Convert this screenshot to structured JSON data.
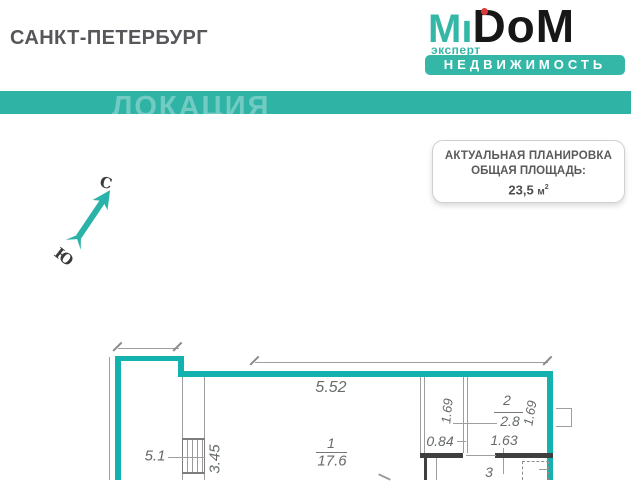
{
  "colors": {
    "brand_teal": "#35b7a8",
    "ribbon_teal": "#2fb3a5",
    "wall_teal": "#14b2ae",
    "logo_dot_red": "#d93a35",
    "logo_black": "#171717"
  },
  "header": {
    "city": "САНКТ-ПЕТЕРБУРГ"
  },
  "logo": {
    "m": "M",
    "i_stem": "ı",
    "rest": "DoM",
    "tagline": "эксперт",
    "banner": "НЕДВИЖИМОСТЬ"
  },
  "ribbon": {
    "watermark": "ЛОКАЦИЯ"
  },
  "badge": {
    "title": "АКТУАЛЬНАЯ ПЛАНИРОВКА",
    "subtitle": "ОБЩАЯ ПЛОЩАДЬ:",
    "value": "23,5",
    "unit": "м",
    "unit_sup": "2"
  },
  "compass": {
    "north": "С",
    "south": "Ю"
  },
  "plan": {
    "dim_top_width": "5.52",
    "dim_left_width": "5.1",
    "dim_wall_depth": "3.45",
    "dim_h_left": "1.69",
    "dim_h_right": "1.69",
    "dim_084": "0.84",
    "dim_163": "1.63",
    "room1": {
      "num": "1",
      "area": "17.6"
    },
    "room2": {
      "num": "2",
      "area": "2.8"
    },
    "room3": {
      "num": "3"
    }
  }
}
